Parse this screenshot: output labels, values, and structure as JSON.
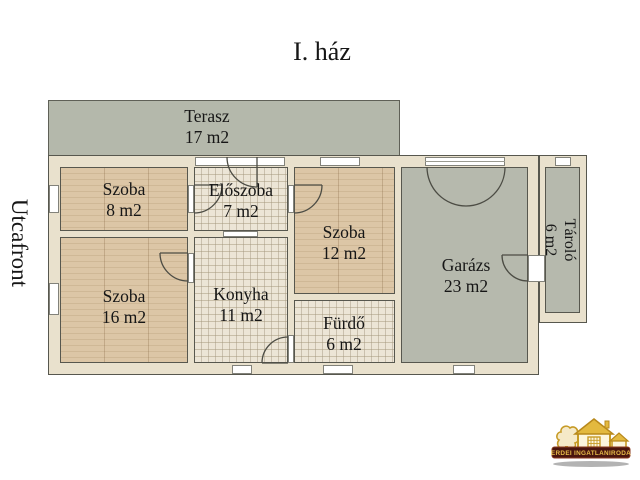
{
  "title": "I. ház",
  "side_label": "Utcafront",
  "rooms": [
    {
      "id": "terasz",
      "name": "Terasz",
      "area": "17 m2"
    },
    {
      "id": "szoba8",
      "name": "Szoba",
      "area": "8 m2"
    },
    {
      "id": "eloszoba",
      "name": "Előszoba",
      "area": "7 m2"
    },
    {
      "id": "szoba12",
      "name": "Szoba",
      "area": "12 m2"
    },
    {
      "id": "szoba16",
      "name": "Szoba",
      "area": "16 m2"
    },
    {
      "id": "konyha",
      "name": "Konyha",
      "area": "11 m2"
    },
    {
      "id": "furdo",
      "name": "Fürdő",
      "area": "6 m2"
    },
    {
      "id": "garazs",
      "name": "Garázs",
      "area": "23 m2"
    },
    {
      "id": "tarolo",
      "name": "Tároló",
      "area": "6 m2"
    }
  ],
  "logo": {
    "text": "ERDEI INGATLANIRODA"
  },
  "colors": {
    "wall": "#e9e1cd",
    "outline": "#57574e",
    "floor_wood": "#d9c2a2",
    "floor_tile": "#ece5d6",
    "concrete": "#b6b9ad",
    "logo_gold": "#c79b26",
    "logo_banner": "#4a150e"
  }
}
